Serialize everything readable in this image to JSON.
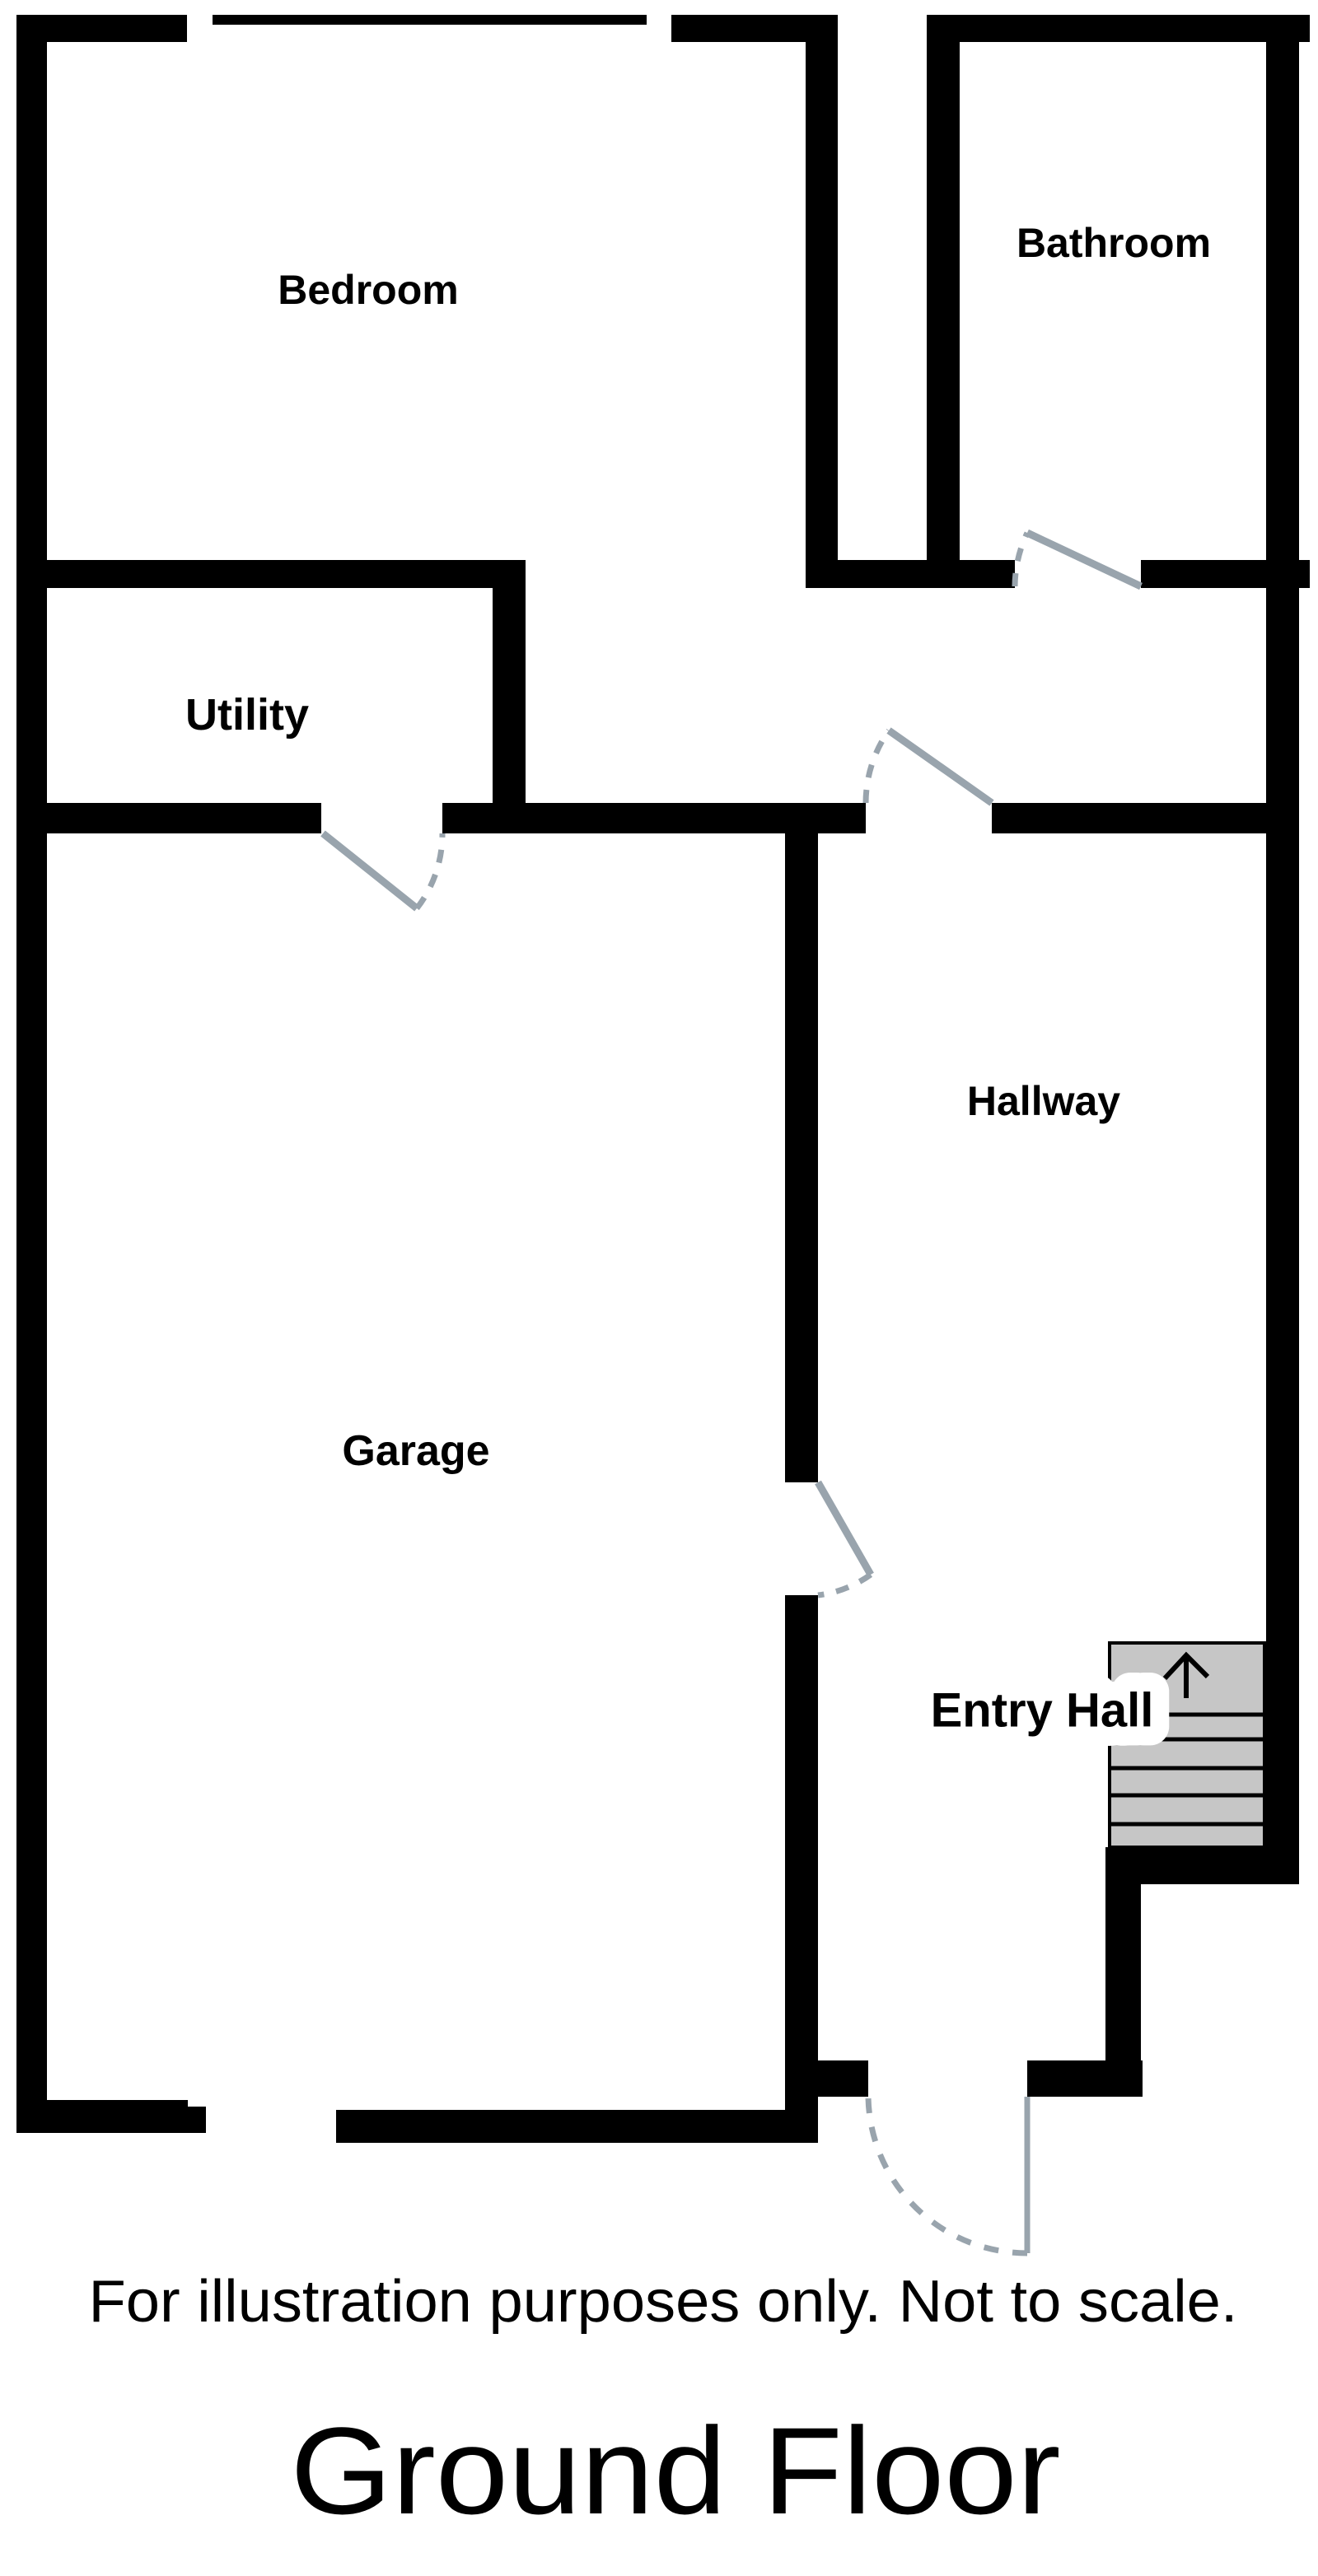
{
  "title": "Ground Floor",
  "disclaimer": "For illustration purposes only. Not to scale.",
  "rooms": {
    "bedroom": {
      "label": "Bedroom"
    },
    "bathroom": {
      "label": "Bathroom"
    },
    "utility": {
      "label": "Utility"
    },
    "garage": {
      "label": "Garage"
    },
    "hallway": {
      "label": "Hallway"
    },
    "entry_hall": {
      "label": "Entry Hall"
    }
  },
  "features": {
    "stairs": {
      "name": "staircase",
      "direction_arrow": "up",
      "visible_treads": 6
    },
    "window": {
      "name": "bedroom-window",
      "location": "top wall of bedroom"
    },
    "doors": [
      {
        "name": "utility-to-garage-door",
        "swing": "down-right into garage"
      },
      {
        "name": "hallway-top-door",
        "swing": "up-left from hallway"
      },
      {
        "name": "bathroom-door",
        "swing": "up-left into bathroom"
      },
      {
        "name": "garage-to-hallway-door",
        "swing": "down-right into hallway"
      },
      {
        "name": "front-entry-door",
        "swing": "down-left to outside"
      }
    ],
    "garage_vehicle_opening": {
      "location": "bottom wall of garage"
    }
  },
  "colors": {
    "wall": "#000000",
    "door_swing": "#99a4ad",
    "stairs_fill": "#c6c6c6",
    "text": "#000000",
    "background": "#ffffff"
  }
}
